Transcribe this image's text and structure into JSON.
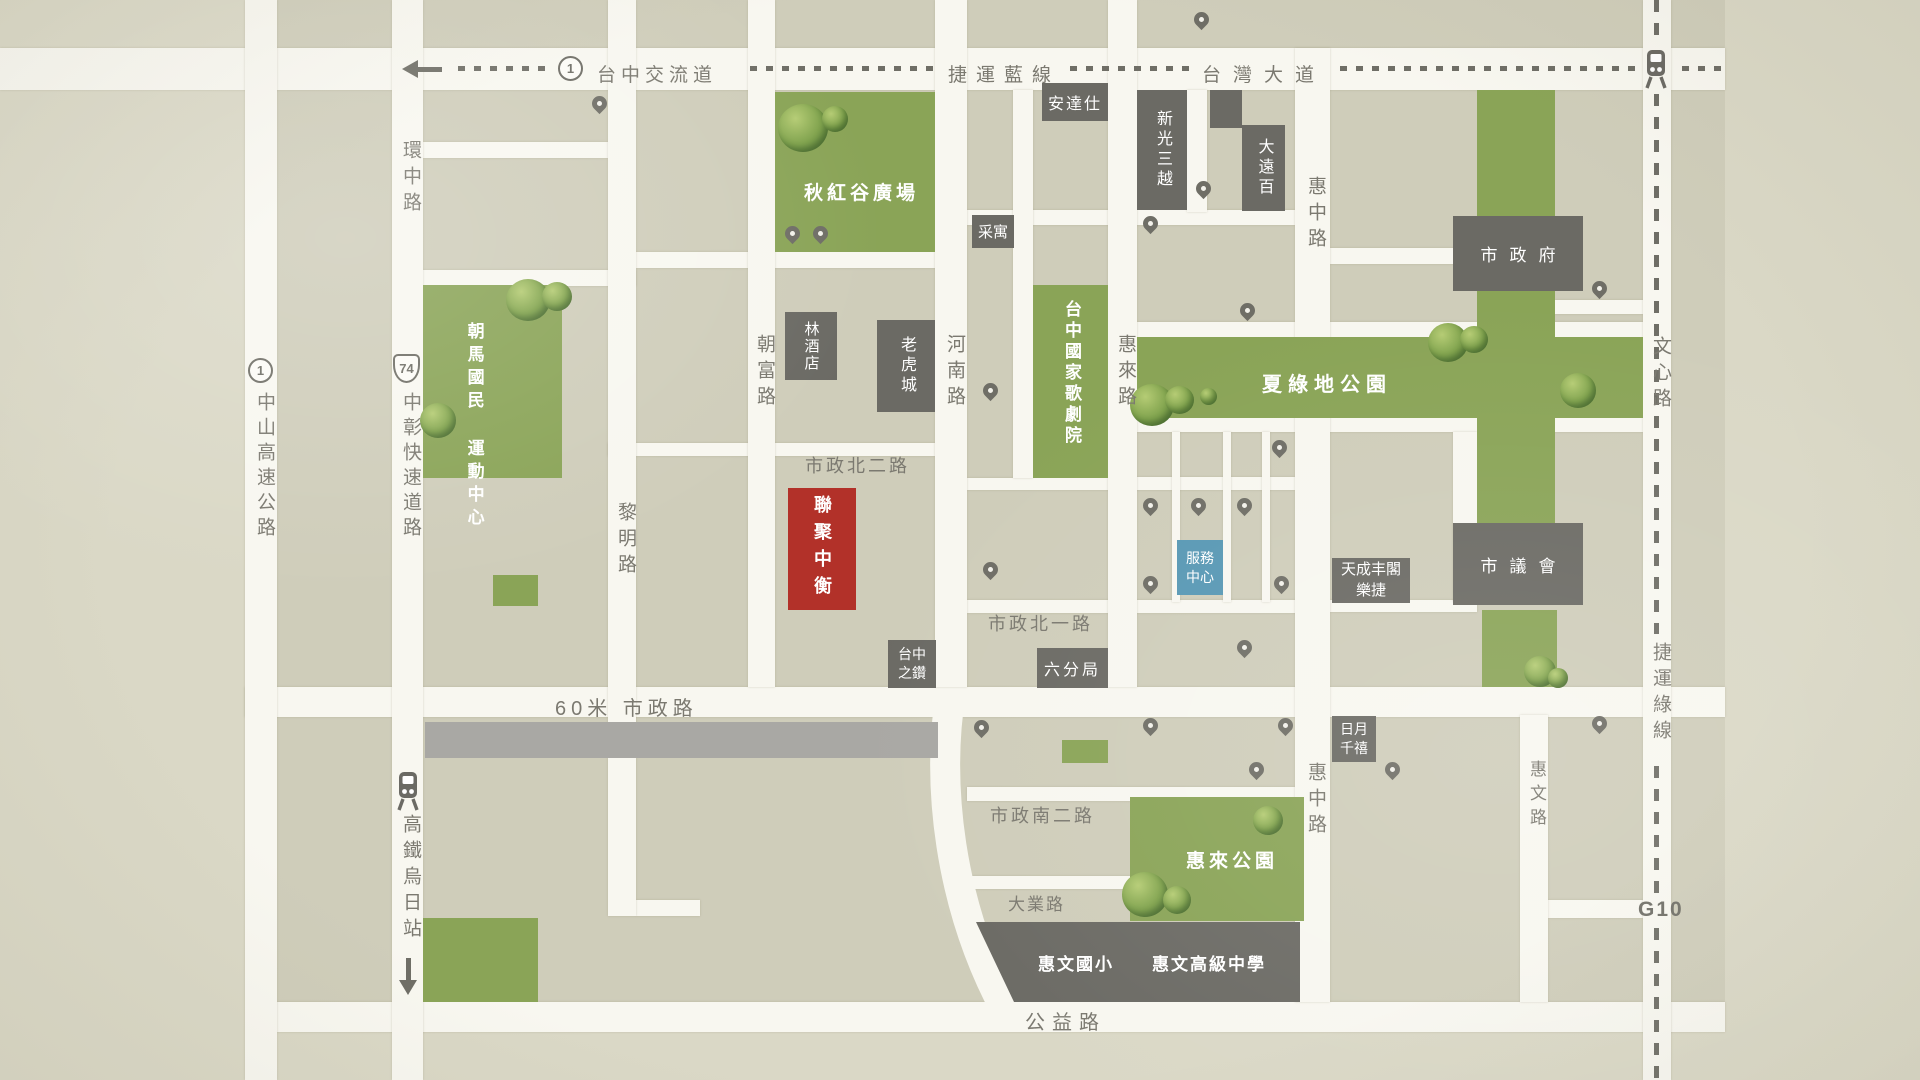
{
  "colors": {
    "paper": "#dad8c6",
    "block": "#cfcdba",
    "road": "#f8f7f0",
    "park_green": "#8aa457",
    "building_gray": "#6b6a64",
    "subject_red": "#b23129",
    "service_blue": "#5898b4",
    "corridor_gray": "#a9a8a4",
    "ink": "#6f6e66"
  },
  "transit": {
    "blue_line": "捷運藍線",
    "green_line": "捷運綠線",
    "g10": "G10",
    "interchange": "台中交流道",
    "interchange_badge": "1",
    "freeway_badge": "1",
    "expressway_badge": "74",
    "hsr_station": "高鐵烏日站"
  },
  "roads": {
    "taiwan_blvd": "台灣大道",
    "huanzhong": "環中路",
    "zhongshan_freeway": "中山高速公路",
    "zhongzhang_expressway": "中彰快速道路",
    "liming": "黎明路",
    "chaofu": "朝富路",
    "henan": "河南路",
    "huilai": "惠來路",
    "huizhong_north": "惠中路",
    "huizhong_south": "惠中路",
    "huiwen": "惠文路",
    "wenxin": "文心路",
    "shizheng_bei_2": "市政北二路",
    "shizheng_bei_1": "市政北一路",
    "shizheng_60m": "60米 市政路",
    "shizheng_nan_2": "市政南二路",
    "daye": "大業路",
    "gongyi": "公益路"
  },
  "parks": {
    "qiuhonggu": "秋紅谷廣場",
    "chaoma_sports": "朝馬國民\n運動中心",
    "xialvdi": "夏綠地公園",
    "huilai_park": "惠來公園"
  },
  "buildings": {
    "subject": "聯聚中衡",
    "andaz": "安達仕",
    "shinkong_mitsukoshi": "新光三越",
    "top_city": "大遠百",
    "caiyu": "采寓",
    "lin_hotel": "林酒店",
    "tiger_city": "老虎城",
    "national_theater": "台中國家歌劇院",
    "city_hall": "市政府",
    "city_council": "市議會",
    "service_center": "服務\n中心",
    "tiancheng": "天成丰閣\n樂捷",
    "sun_moon_millennium": "日月\n千禧",
    "taichung_diamond": "台中\n之鑽",
    "sixth_precinct": "六分局",
    "huiwen_elementary": "惠文國小",
    "huiwen_high_school": "惠文高級中學"
  }
}
